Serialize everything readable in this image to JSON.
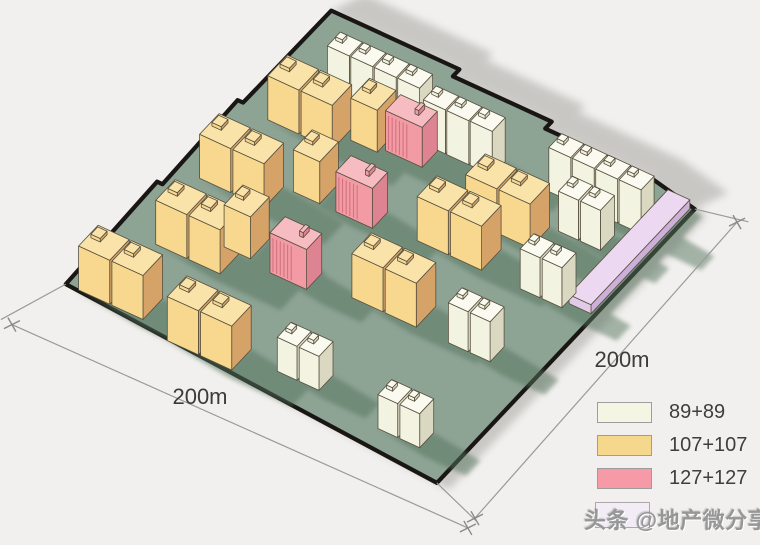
{
  "site": {
    "dim_bottom_label": "200m",
    "dim_right_label": "200m"
  },
  "legend": {
    "items": [
      {
        "id": "89-89",
        "label": "89+89",
        "color": "#f4f6e3"
      },
      {
        "id": "107-107",
        "label": "107+107",
        "color": "#f6d88c"
      },
      {
        "id": "127-127",
        "label": "127+127",
        "color": "#f59aa6"
      }
    ],
    "partial_swatch_color": "#f1ecf5"
  },
  "watermark": {
    "text": "头条 @地产微分享"
  },
  "colors": {
    "background": "#f1f0ee",
    "ground": "#8da394",
    "boundary": "#191613",
    "ground_shadow": "#56745f",
    "outer_shadow": "#a9a7a3",
    "outline": "#57503f",
    "dim_line": "#9c9a96",
    "tick": "#8b8987",
    "label_text": "#3b3b3b"
  },
  "diagram": {
    "origin": [
      330,
      12
    ],
    "u": [
      366,
      168
    ],
    "v": [
      -260,
      276
    ],
    "shadow_vec": [
      0.18,
      0.022
    ],
    "boundary": [
      [
        0,
        -0.005
      ],
      [
        0.35,
        -0.005
      ],
      [
        0.35,
        0.02
      ],
      [
        0.62,
        0.02
      ],
      [
        0.62,
        0.045
      ],
      [
        0.9,
        0.045
      ],
      [
        1.05,
        0.075
      ],
      [
        1.05,
        1.067
      ],
      [
        -0.015,
        0.995
      ],
      [
        -0.025,
        0.63
      ],
      [
        -0.01,
        0.63
      ],
      [
        -0.018,
        0.33
      ],
      [
        -0.003,
        0.33
      ]
    ],
    "wall_band": [
      [
        0,
        -0.005
      ],
      [
        0.35,
        -0.005
      ],
      [
        0.35,
        0.02
      ],
      [
        0.62,
        0.02
      ],
      [
        0.62,
        0.045
      ],
      [
        0.9,
        0.045
      ],
      [
        1.05,
        0.075
      ]
    ],
    "palettes": {
      "white": {
        "front": "#f2f3e1",
        "side": "#dbd8c2",
        "top": "#fafaf0"
      },
      "yellow": {
        "front": "#f7d88e",
        "side": "#d5a368",
        "top": "#f9e3a9"
      },
      "pink": {
        "front": "#f29ba5",
        "side": "#dd8392",
        "top": "#f6bcc1",
        "ribs": "#d2737f"
      },
      "lavender": {
        "front": "#e2cbe9",
        "side": "#cdafd9",
        "top": "#ecd9f1"
      }
    },
    "specs": {
      "slabRow": {
        "w": 0.06,
        "d": 0.05,
        "gap": 0.004,
        "h": 44
      },
      "pair": {
        "w": 0.085,
        "d": 0.075,
        "gap": 0.006,
        "h": 44
      },
      "single": {
        "w": 0.072,
        "d": 0.072,
        "h": 42
      },
      "ribbed": {
        "w": 0.1,
        "d": 0.058,
        "h": 40
      },
      "smallPair": {
        "w": 0.054,
        "d": 0.054,
        "gap": 0.006,
        "h": 36
      },
      "strip": {
        "w": 0.06,
        "d": 0.38,
        "h": 9
      }
    },
    "clusters": [
      {
        "kind": "slabRow",
        "pal": "white",
        "x": 0.135,
        "y": 0.15,
        "n": 4
      },
      {
        "kind": "slabRow",
        "pal": "white",
        "x": 0.415,
        "y": 0.175,
        "n": 3
      },
      {
        "kind": "slabRow",
        "pal": "white",
        "x": 0.74,
        "y": 0.15,
        "n": 4
      },
      {
        "kind": "pair",
        "pal": "yellow",
        "x": 0.075,
        "y": 0.27
      },
      {
        "kind": "single",
        "pal": "yellow",
        "x": 0.27,
        "y": 0.228
      },
      {
        "kind": "ribbed",
        "pal": "pink",
        "x": 0.355,
        "y": 0.228
      },
      {
        "kind": "pair",
        "pal": "yellow",
        "x": 0.63,
        "y": 0.29
      },
      {
        "kind": "smallPair",
        "pal": "white",
        "x": 0.83,
        "y": 0.235,
        "h": 40
      },
      {
        "kind": "strip",
        "pal": "lavender",
        "x": 0.98,
        "y": 0.08
      },
      {
        "kind": "pair",
        "pal": "yellow",
        "x": 0.05,
        "y": 0.497
      },
      {
        "kind": "single",
        "pal": "yellow",
        "x": 0.253,
        "y": 0.425
      },
      {
        "kind": "ribbed",
        "pal": "pink",
        "x": 0.37,
        "y": 0.44
      },
      {
        "kind": "pair",
        "pal": "yellow",
        "x": 0.577,
        "y": 0.402
      },
      {
        "kind": "smallPair",
        "pal": "white",
        "x": 0.86,
        "y": 0.425,
        "h": 40
      },
      {
        "kind": "pair",
        "pal": "yellow",
        "x": 0.085,
        "y": 0.715
      },
      {
        "kind": "single",
        "pal": "yellow",
        "x": 0.22,
        "y": 0.645
      },
      {
        "kind": "ribbed",
        "pal": "pink",
        "x": 0.354,
        "y": 0.671
      },
      {
        "kind": "pair",
        "pal": "yellow",
        "x": 0.555,
        "y": 0.622
      },
      {
        "kind": "smallPair",
        "pal": "white",
        "x": 0.82,
        "y": 0.645,
        "h": 40
      },
      {
        "kind": "pair",
        "pal": "yellow",
        "x": 0.02,
        "y": 0.92
      },
      {
        "kind": "pair",
        "pal": "yellow",
        "x": 0.28,
        "y": 0.945
      },
      {
        "kind": "smallPair",
        "pal": "white",
        "x": 0.545,
        "y": 0.916,
        "h": 34
      },
      {
        "kind": "smallPair",
        "pal": "white",
        "x": 0.84,
        "y": 0.944,
        "h": 34
      }
    ],
    "dimensions": {
      "dim_lines": [
        {
          "from": [
            -0.045,
            1.16
          ],
          "to": [
            1.19,
            1.145
          ]
        },
        {
          "from": [
            1.154,
            0.059
          ],
          "to": [
            1.186,
            1.112
          ]
        }
      ],
      "ext_lines": [
        {
          "from": [
            1.05,
            0.075
          ],
          "to": [
            1.175,
            0.045
          ]
        },
        {
          "from": [
            -0.015,
            0.995
          ],
          "to": [
            -0.075,
            1.16
          ]
        },
        {
          "from": [
            1.05,
            1.067
          ],
          "to": [
            1.195,
            1.118
          ]
        }
      ],
      "ticks": [
        [
          -0.045,
          1.16
        ],
        [
          1.19,
          1.145
        ],
        [
          1.154,
          0.059
        ],
        [
          1.186,
          1.112
        ]
      ]
    }
  }
}
